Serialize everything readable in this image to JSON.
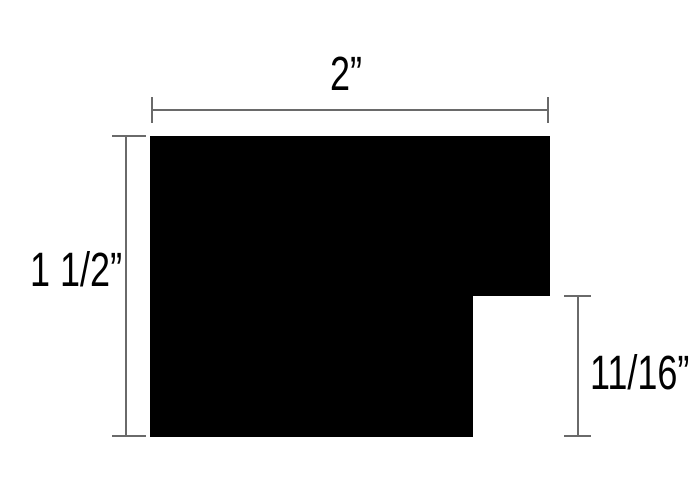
{
  "diagram": {
    "type": "technical-dimension-drawing",
    "colors": {
      "background": "#ffffff",
      "shape": "#000000",
      "dimension_line": "#6a6a6a",
      "text": "#000000"
    },
    "dimensions": {
      "width": {
        "label": "2”"
      },
      "height": {
        "label": "1 1/2”"
      },
      "notch_height": {
        "label": "11/16”"
      }
    }
  }
}
